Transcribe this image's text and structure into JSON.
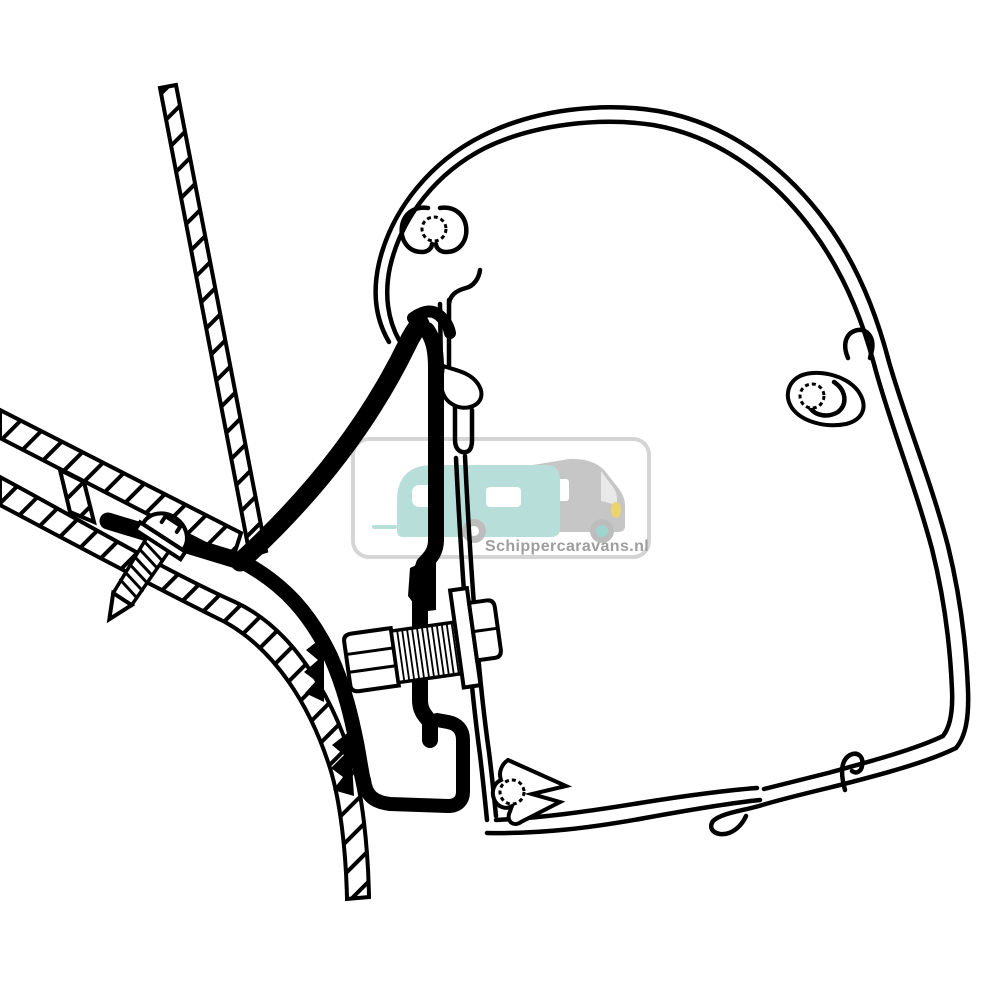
{
  "page": {
    "background": "#ffffff",
    "drawing_line_color": "#000000"
  },
  "watermark": {
    "brand_text": "Schippercaravans.nl",
    "text_color": "#9e9e9e",
    "border_color": "#d5d5d5",
    "caravan_color": "#b7ded9",
    "motorhome_color": "#c6c6c6",
    "windshield_color": "#e9e9e9",
    "window_color": "#ffffff",
    "wheel_color": "#bdbdbd",
    "wheel_hub_color": "#9fd4cc",
    "headlight_color": "#ecd36e",
    "drawbar_color": "#b7ded9"
  },
  "diagram": {
    "parts": [
      "vehicle-wall-panel-hatched",
      "vehicle-roof-panel-hatched",
      "roof-panel-web",
      "self-tapping-screw",
      "adapter-bracket-black-profile",
      "gasket-teeth",
      "hex-bolt",
      "threaded-shank",
      "clamp-plate-washer",
      "hex-nut",
      "awning-rail-profile",
      "screw-channel-boss-top-left",
      "screw-channel-boss-right",
      "screw-channel-boss-bottom",
      "rail-bottom-hook"
    ]
  }
}
